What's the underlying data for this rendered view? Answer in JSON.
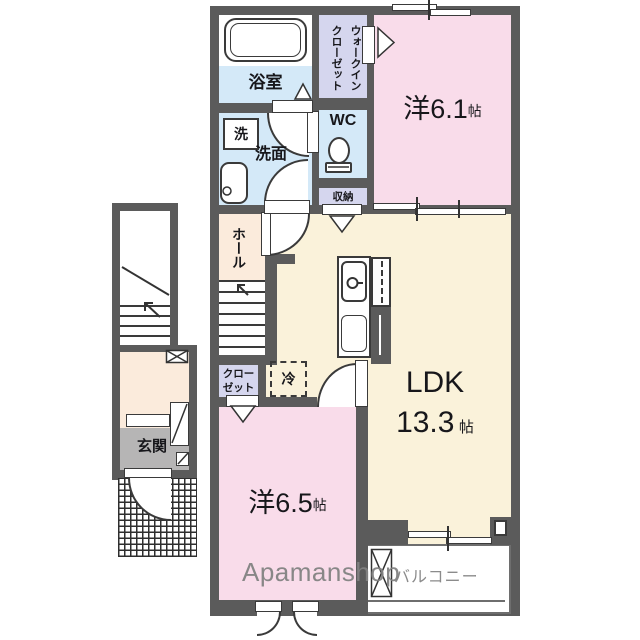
{
  "plan": {
    "watermark": "Apamanshop",
    "rooms": {
      "bathroom": {
        "label": "浴室"
      },
      "walk_in_closet": {
        "label": "ウォークインクローゼット",
        "line1": "ウォークイン",
        "line2": "クローゼット"
      },
      "washroom": {
        "label": "洗面"
      },
      "wc": {
        "label": "WC"
      },
      "storage": {
        "label": "収納"
      },
      "western_room_1": {
        "name": "洋6.1",
        "unit": "帖",
        "tatami": 6.1
      },
      "hall": {
        "label": "ホール"
      },
      "closet": {
        "label": "クローゼット",
        "line1": "クロー",
        "line2": "ゼット"
      },
      "ldk": {
        "name": "LDK",
        "size": "13.3",
        "unit": "帖",
        "tatami": 13.3
      },
      "western_room_2": {
        "name": "洋6.5",
        "unit": "帖",
        "tatami": 6.5
      },
      "entrance": {
        "label": "玄関"
      },
      "balcony": {
        "label": "バルコニー"
      }
    },
    "fixtures": {
      "washer": {
        "label": "洗"
      },
      "fridge": {
        "label": "冷"
      }
    },
    "colors": {
      "wall": "#5b5b5b",
      "wet_area_blue": "#d4e9f8",
      "closet_lavender": "#d5d6ee",
      "bedroom_pink": "#f9dcea",
      "ldk_cream": "#faf2da",
      "hall_peach": "#fbebdc",
      "entrance_gray": "#b6b5b5",
      "watermark_gray": "#8b8b8b"
    }
  }
}
